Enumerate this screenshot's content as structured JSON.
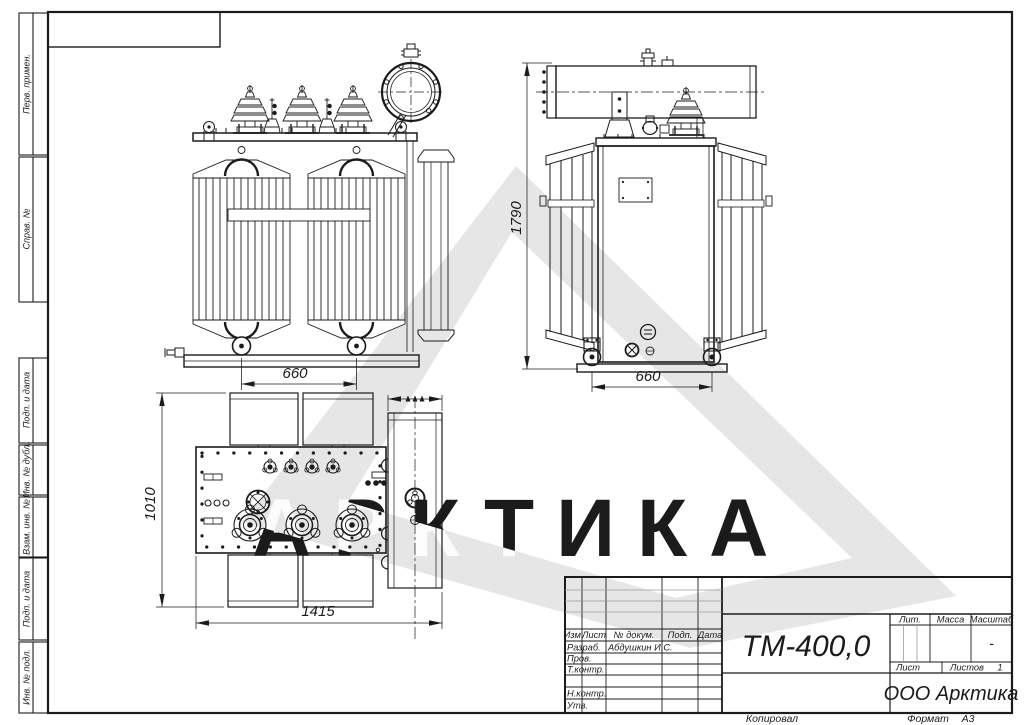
{
  "watermark": {
    "text": "АРКТИКА",
    "shape_color": "#e6e6e6",
    "text_color": "#d4d4d4"
  },
  "frame": {
    "left_stamps": [
      {
        "label": "Перв. примен."
      },
      {
        "label": "Справ. №"
      },
      {
        "label": "Подп. и дата"
      },
      {
        "label": "Инв. № дубл."
      },
      {
        "label": "Взам. инв. №"
      },
      {
        "label": "Подп. и дата"
      },
      {
        "label": "Инв. № подл."
      }
    ]
  },
  "views": {
    "front": {
      "dim_width": "660"
    },
    "side": {
      "dim_height": "1790",
      "dim_width": "660"
    },
    "top": {
      "dim_height": "1010",
      "dim_length": "1415"
    }
  },
  "title_block": {
    "cols": {
      "izm": "Изм.",
      "list": "Лист",
      "doc": "№ докум.",
      "sign": "Подп.",
      "date": "Дата"
    },
    "rows": {
      "developed": "Разраб.",
      "checked": "Пров.",
      "tcontrol": "Т.контр.",
      "ncontrol": "Н.контр.",
      "approved": "Утв."
    },
    "developer_name": "Абдушкин И.С.",
    "designation": "ТМ-400,0",
    "lit_label": "Лит.",
    "mass_label": "Масса",
    "scale_label": "Масштаб",
    "scale_value": "-",
    "sheet_label": "Лист",
    "sheets_label": "Листов",
    "sheets_value": "1",
    "company": "ООО Арктика"
  },
  "footer": {
    "copied": "Копировал",
    "format_label": "Формат",
    "format_value": "А3"
  }
}
